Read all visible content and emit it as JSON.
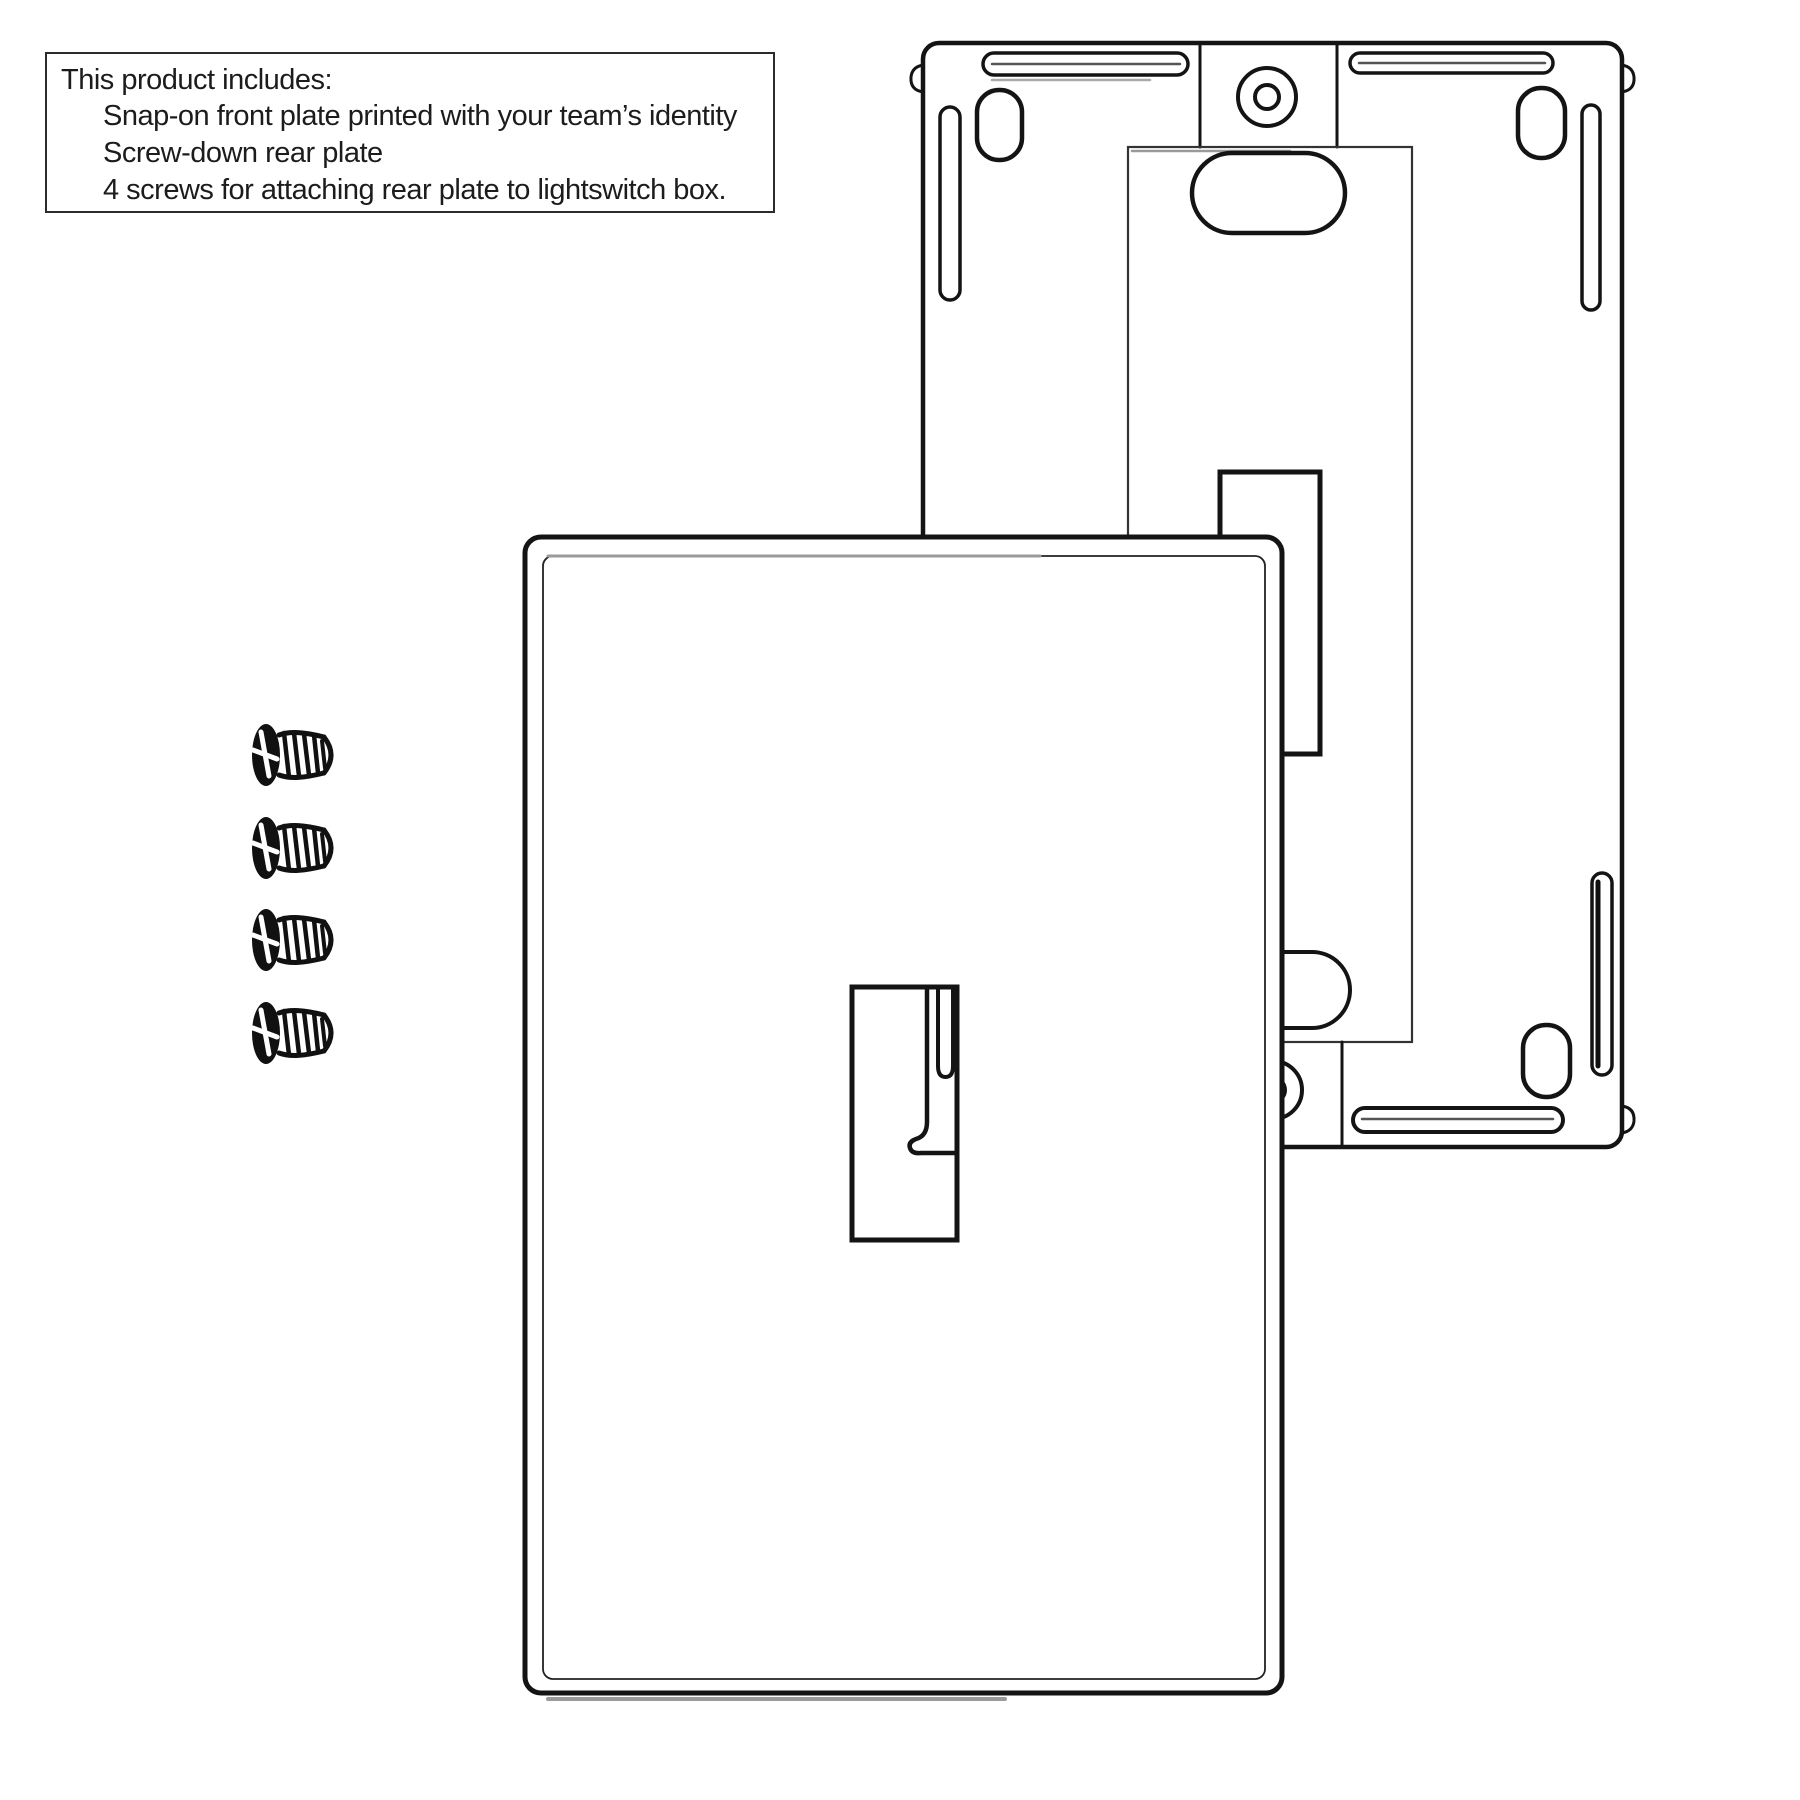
{
  "page": {
    "width": 1800,
    "height": 1800,
    "background": "#ffffff",
    "line_color": "#141414",
    "thin_line_color": "#333333",
    "shade_color": "#9a9a9a"
  },
  "info_box": {
    "title": "This product includes:",
    "items": [
      "Snap-on front plate printed with your team’s identity",
      "Screw-down rear plate",
      "4 screws for attaching rear plate to lightswitch box."
    ]
  },
  "diagram": {
    "parts": {
      "front_plate": "Snap-on front plate",
      "rear_plate": "Screw-down rear plate",
      "screws": "Mounting screws"
    },
    "screws": {
      "count": 4,
      "head_center_x": 266,
      "centers_y": [
        755,
        848,
        940,
        1033
      ]
    }
  }
}
